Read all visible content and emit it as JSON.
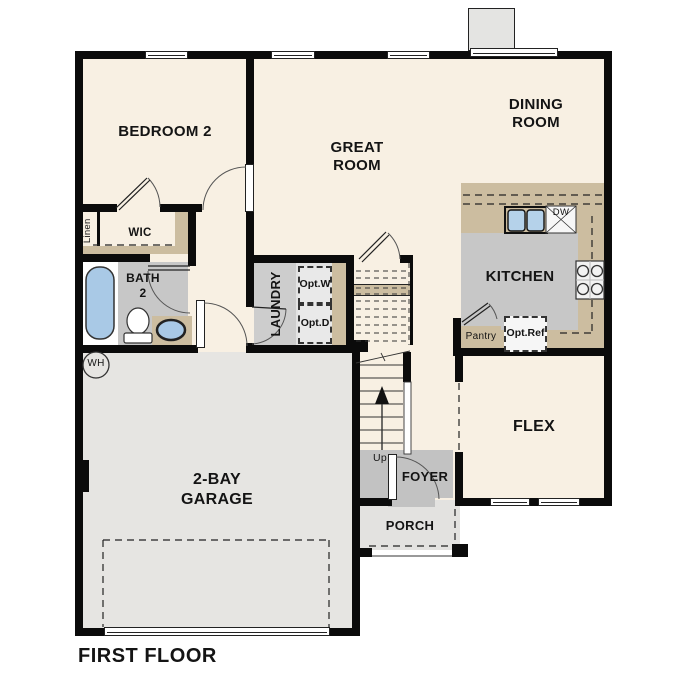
{
  "plan": {
    "title": "FIRST FLOOR",
    "rooms": {
      "bedroom2": {
        "label": "BEDROOM 2"
      },
      "great_room": {
        "line1": "GREAT",
        "line2": "ROOM"
      },
      "dining_room": {
        "line1": "DINING",
        "line2": "ROOM"
      },
      "kitchen": {
        "label": "KITCHEN"
      },
      "flex": {
        "label": "FLEX"
      },
      "garage": {
        "line1": "2-BAY",
        "line2": "GARAGE"
      },
      "foyer": {
        "label": "FOYER"
      },
      "porch": {
        "label": "PORCH"
      },
      "laundry": {
        "label": "LAUNDRY"
      },
      "bath2": {
        "line1": "BATH",
        "line2": "2"
      },
      "wic": {
        "label": "WIC"
      },
      "linen": {
        "label": "Linen"
      },
      "pantry": {
        "label": "Pantry"
      }
    },
    "annotations": {
      "up": "Up",
      "water_heater": "WH",
      "dishwasher": "DW",
      "opt_washer": {
        "line1": "Opt.",
        "line2": "W"
      },
      "opt_dryer": {
        "line1": "Opt.",
        "line2": "D"
      },
      "opt_ref": {
        "line1": "Opt.",
        "line2": "Ref"
      }
    },
    "colors": {
      "wall": "#0b0b0b",
      "interior_cream": "#f8f0e3",
      "counter_tan": "#ccbda0",
      "floor_gray": "#c7c7c7",
      "garage_gray": "#e6e5e2",
      "fixture_blue": "#a9c9e6"
    }
  }
}
